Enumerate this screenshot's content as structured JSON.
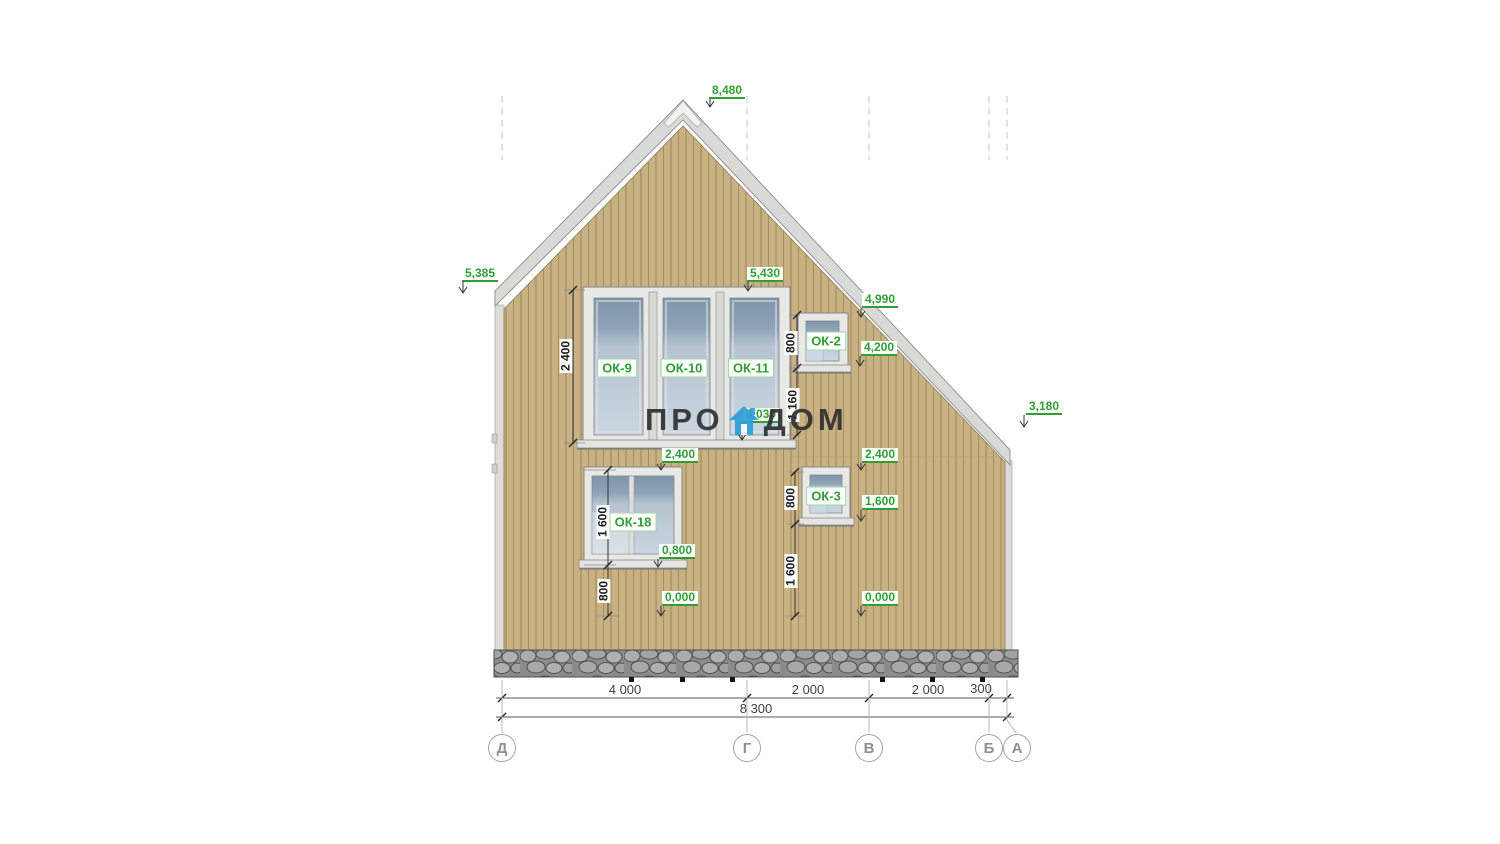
{
  "watermark": {
    "pro": "ПРО",
    "dom": "ДОМ",
    "icon": "house-icon",
    "icon_color": "#2e9ed8"
  },
  "windows": {
    "ok9": "ОК-9",
    "ok10": "ОК-10",
    "ok11": "ОК-11",
    "ok2": "ОК-2",
    "ok18": "ОК-18",
    "ok3": "ОК-3"
  },
  "elevations": {
    "peak": "8,480",
    "eave_left": "5,385",
    "upper_window_top": "5,430",
    "roof_right_upper": "4,990",
    "roof_right_lower": "4,200",
    "eave_right": "3,180",
    "upper_window_sill": "3,030",
    "ok18_top": "2,400",
    "ok3_top": "2,400",
    "ok3_sill": "1,600",
    "ok18_sill": "0,800",
    "ground_left": "0,000",
    "ground_right": "0,000"
  },
  "vertical_dims": {
    "upper_window_height": "2 400",
    "ok2_height": "800",
    "below_ok2": "1 160",
    "ok18_height": "1 600",
    "below_ok18": "800",
    "ok3_height": "800",
    "below_ok3": "1 600"
  },
  "bottom_dims": {
    "seg_d_g": "4 000",
    "seg_g_v": "2 000",
    "seg_v_b": "2 000",
    "seg_b_a": "300",
    "total": "8 300"
  },
  "axes": {
    "d": "Д",
    "g": "Г",
    "v": "В",
    "b": "Б",
    "a": "А"
  },
  "colors": {
    "siding": "#c8b284",
    "plank_line": "#a68e5e",
    "roof": "#d9d9d7",
    "stone": "#acacaa",
    "accent_green": "#2f9e33",
    "glass_top": "#8ea3b7",
    "glass_bottom": "#c9d5df",
    "watermark_blue": "#2e9ed8"
  }
}
